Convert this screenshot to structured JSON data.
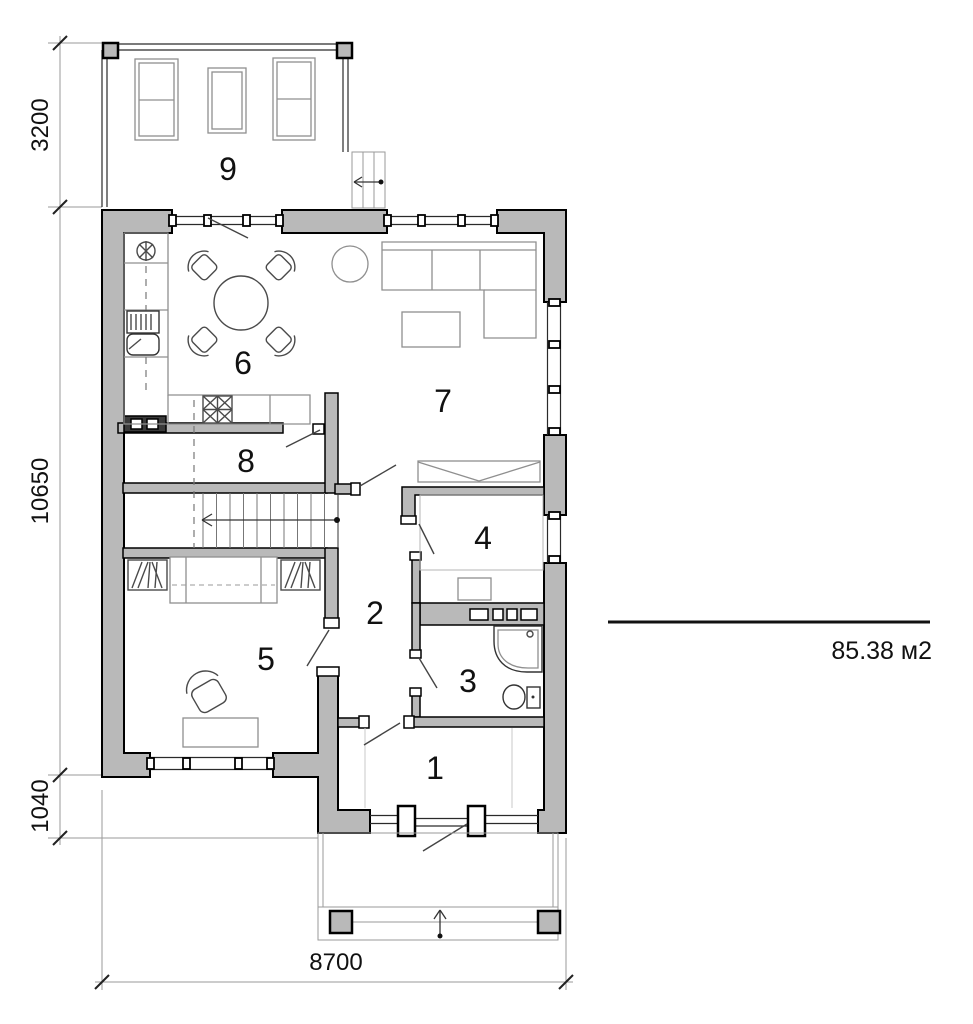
{
  "colors": {
    "wall_fill": "#b9b9b9",
    "ink": "#111111"
  },
  "dimensions": {
    "terrace_depth": "3200",
    "house_length": "10650",
    "porch_offset": "1040",
    "house_width": "8700"
  },
  "area": {
    "value": "85.38 м2"
  },
  "rooms": {
    "r1": "1",
    "r2": "2",
    "r3": "3",
    "r4": "4",
    "r5": "5",
    "r6": "6",
    "r7": "7",
    "r8": "8",
    "r9": "9"
  }
}
